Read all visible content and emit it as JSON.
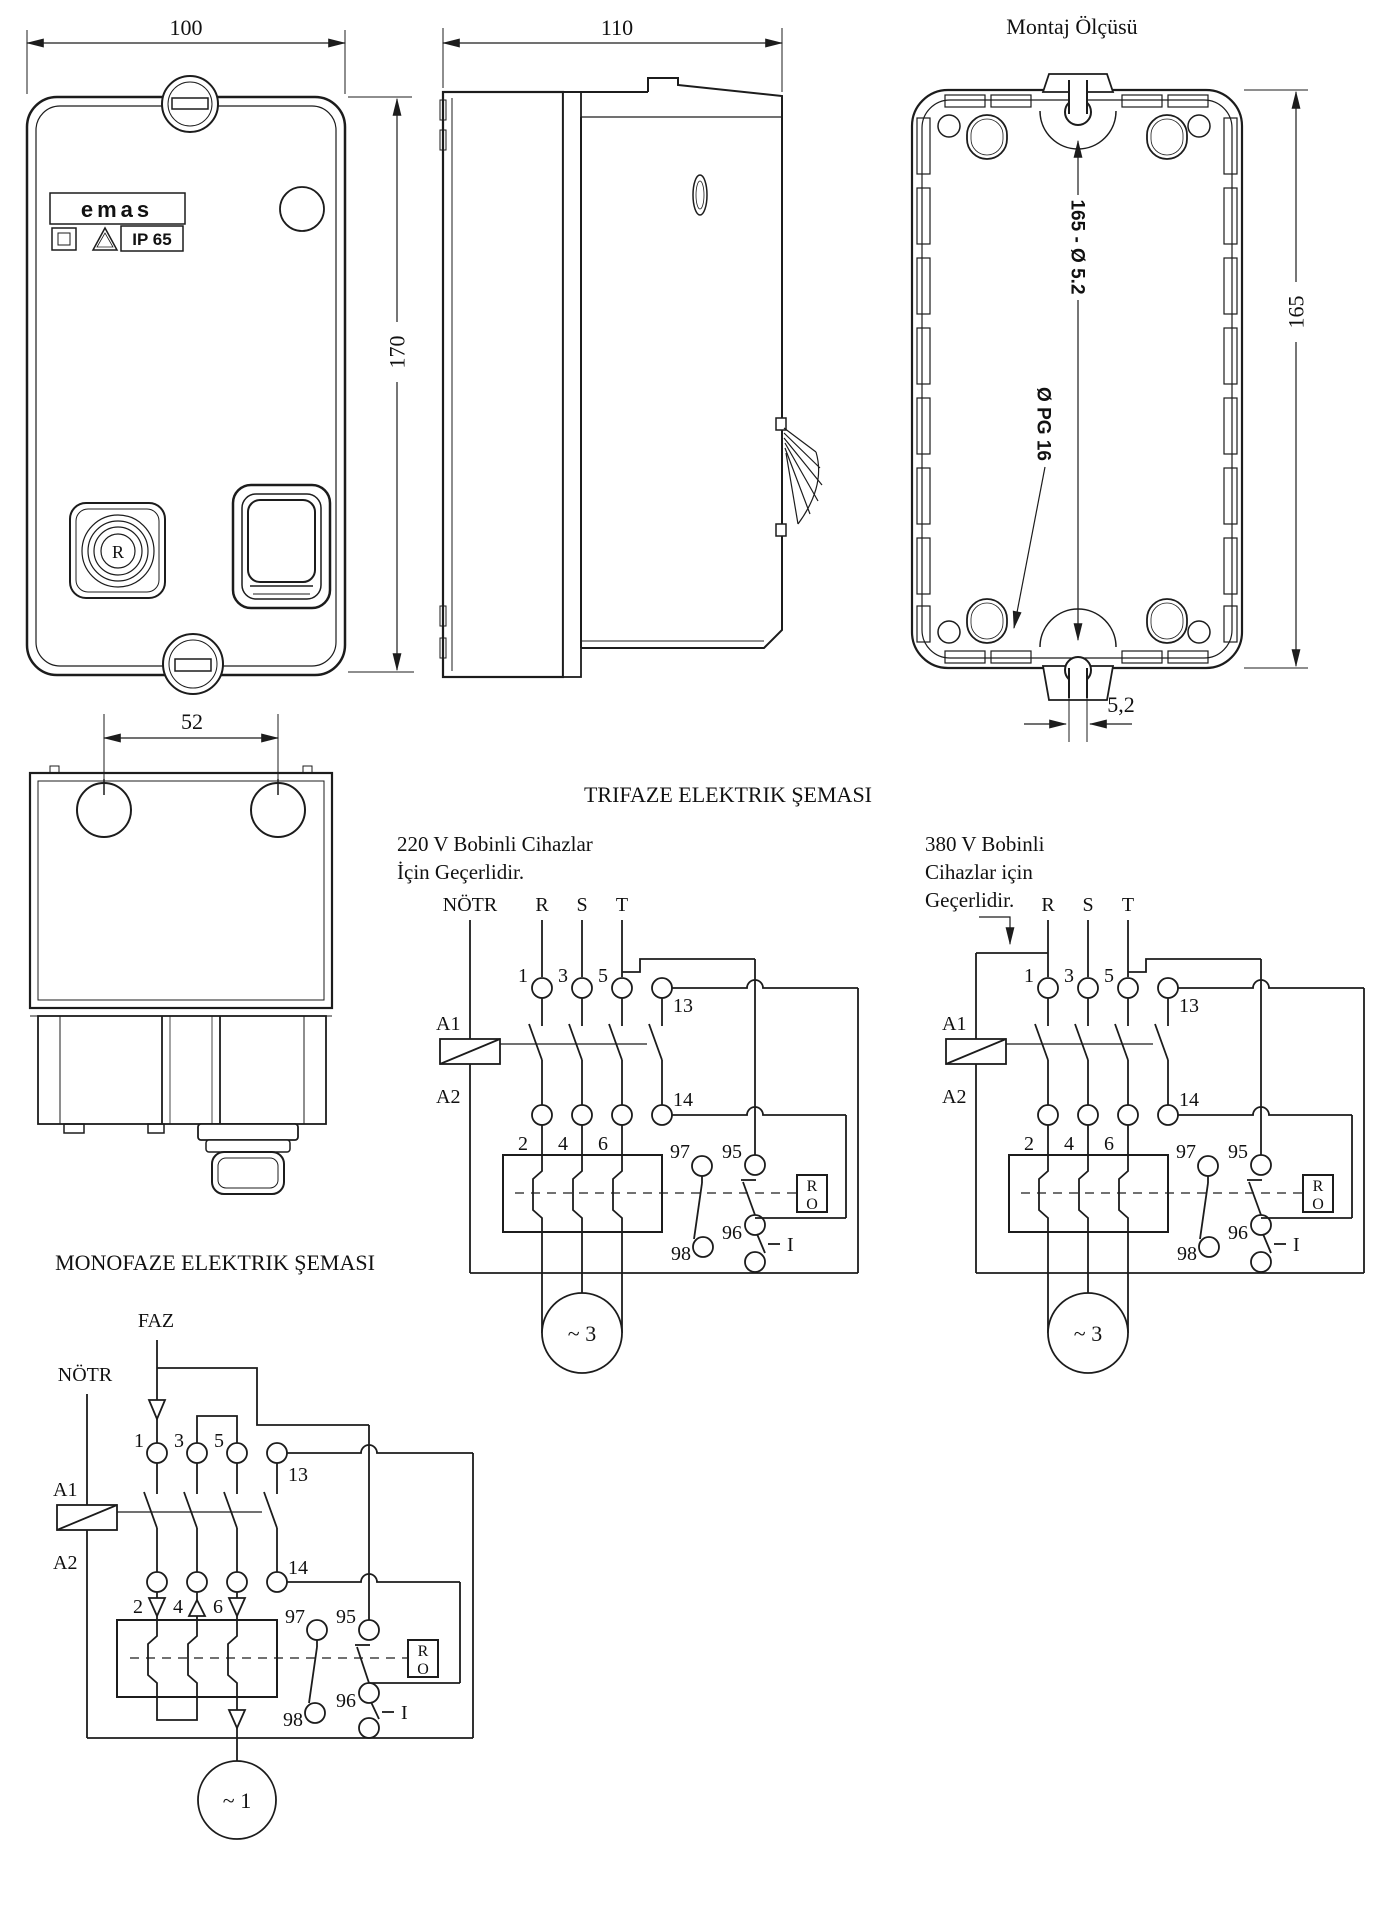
{
  "mounting_title": "Montaj Ölçüsü",
  "dimensions": {
    "front_width": "100",
    "front_height": "170",
    "side_depth": "110",
    "bottom_centers": "52",
    "mount_holes": "165 - Ø 5.2",
    "mount_gland": "Ø PG 16",
    "mount_height": "165",
    "mount_slot": "5,2"
  },
  "front": {
    "brand": "emas",
    "ip_rating": "IP 65",
    "reset_button": "R"
  },
  "schematics": {
    "trifaze_title": "TRIFAZE ELEKTRIK ŞEMASI",
    "monofaze_title": "MONOFAZE ELEKTRIK ŞEMASI",
    "note_220": [
      "220 V Bobinli Cihazlar",
      "İçin Geçerlidir."
    ],
    "note_380": [
      "380 V Bobinli",
      "Cihazlar için",
      "Geçerlidir."
    ],
    "labels": {
      "neutral": "NÖTR",
      "phase": "FAZ",
      "phases": [
        "R",
        "S",
        "T"
      ],
      "coil_terms": [
        "A1",
        "A2"
      ],
      "input_terms": [
        "1",
        "3",
        "5"
      ],
      "output_terms": [
        "2",
        "4",
        "6"
      ],
      "aux_terms": [
        "13",
        "14"
      ],
      "overload_terms": [
        "97",
        "95",
        "98",
        "96"
      ],
      "relay_box": [
        "R",
        "O"
      ],
      "start_switch": "I",
      "motor_three_phase": "~ 3",
      "motor_single_phase": "~ 1"
    }
  },
  "colors": {
    "line": "#1c1c1c",
    "background": "#ffffff"
  }
}
